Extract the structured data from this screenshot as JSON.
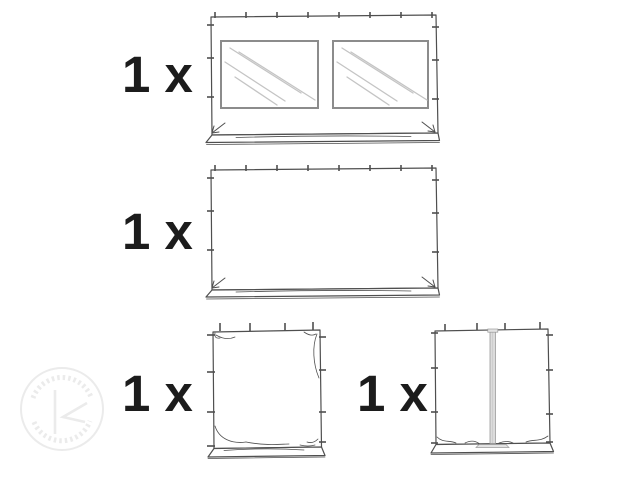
{
  "page": {
    "background": "#ffffff"
  },
  "items": [
    {
      "qty_label": "1 x",
      "part_icon": "sidewall-with-two-windows"
    },
    {
      "qty_label": "1 x",
      "part_icon": "sidewall-plain-full-width"
    },
    {
      "qty_label": "1 x",
      "part_icon": "sidewall-plain-half-width"
    },
    {
      "qty_label": "1 x",
      "part_icon": "sidewall-with-center-zipper-door"
    }
  ],
  "watermark": {
    "icon": "circular-logo-watermark"
  },
  "colors": {
    "ink": "#4f4f4f",
    "label": "#1c1c1c",
    "window-frame": "#8c8c8c",
    "window-glass-line": "#c4c4c4",
    "zipper-fill": "#dcdcdc",
    "zipper-edge": "#9b9b9b",
    "watermark": "#ebebeb",
    "background": "#ffffff"
  }
}
